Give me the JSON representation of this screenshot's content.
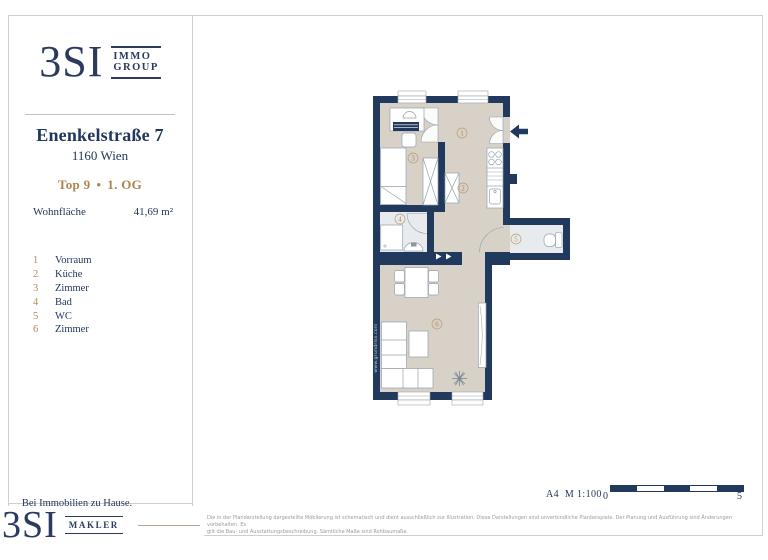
{
  "brand_top": {
    "name": "3SI",
    "line1": "IMMO",
    "line2": "GROUP"
  },
  "address": {
    "street": "Enenkelstraße 7",
    "city": "1160 Wien",
    "unit": "Top 9",
    "bullet": "•",
    "floor": "1. OG"
  },
  "area": {
    "label": "Wohnfläche",
    "value": "41,69 m²"
  },
  "rooms": [
    {
      "number": "1",
      "label": "Vorraum"
    },
    {
      "number": "2",
      "label": "Küche"
    },
    {
      "number": "3",
      "label": "Zimmer"
    },
    {
      "number": "4",
      "label": "Bad"
    },
    {
      "number": "5",
      "label": "WC"
    },
    {
      "number": "6",
      "label": "Zimmer"
    }
  ],
  "tagline": "Bei Immobilien zu Hause.",
  "brand_bottom": {
    "name": "3SI",
    "sub": "MAKLER"
  },
  "plan": {
    "watermark": "www.grundriss.com"
  },
  "footer": {
    "format_scale": "A4  M 1:100",
    "scale_start": "0",
    "scale_end": "5",
    "disclaimer_line1": "Die in der Plandarstellung dargestellte Möblierung ist schematisch und dient ausschließlich zur Illustration. Diese Darstellungen sind unverbindliche Planbeispiele. Der Planung und Ausführung sind Änderungen vorbehalten. Es",
    "disclaimer_line2": "gilt die Bau- und Ausstattungsbeschreibung. Sämtliche Maße sind Rohbaumaße."
  },
  "colors": {
    "navy": "#2b3a5e",
    "wall": "#20395c",
    "gold": "#ab8550",
    "floor_beige": "#d8d1c8",
    "floor_tile": "#e8ebed",
    "frame": "#cfcfcf"
  }
}
